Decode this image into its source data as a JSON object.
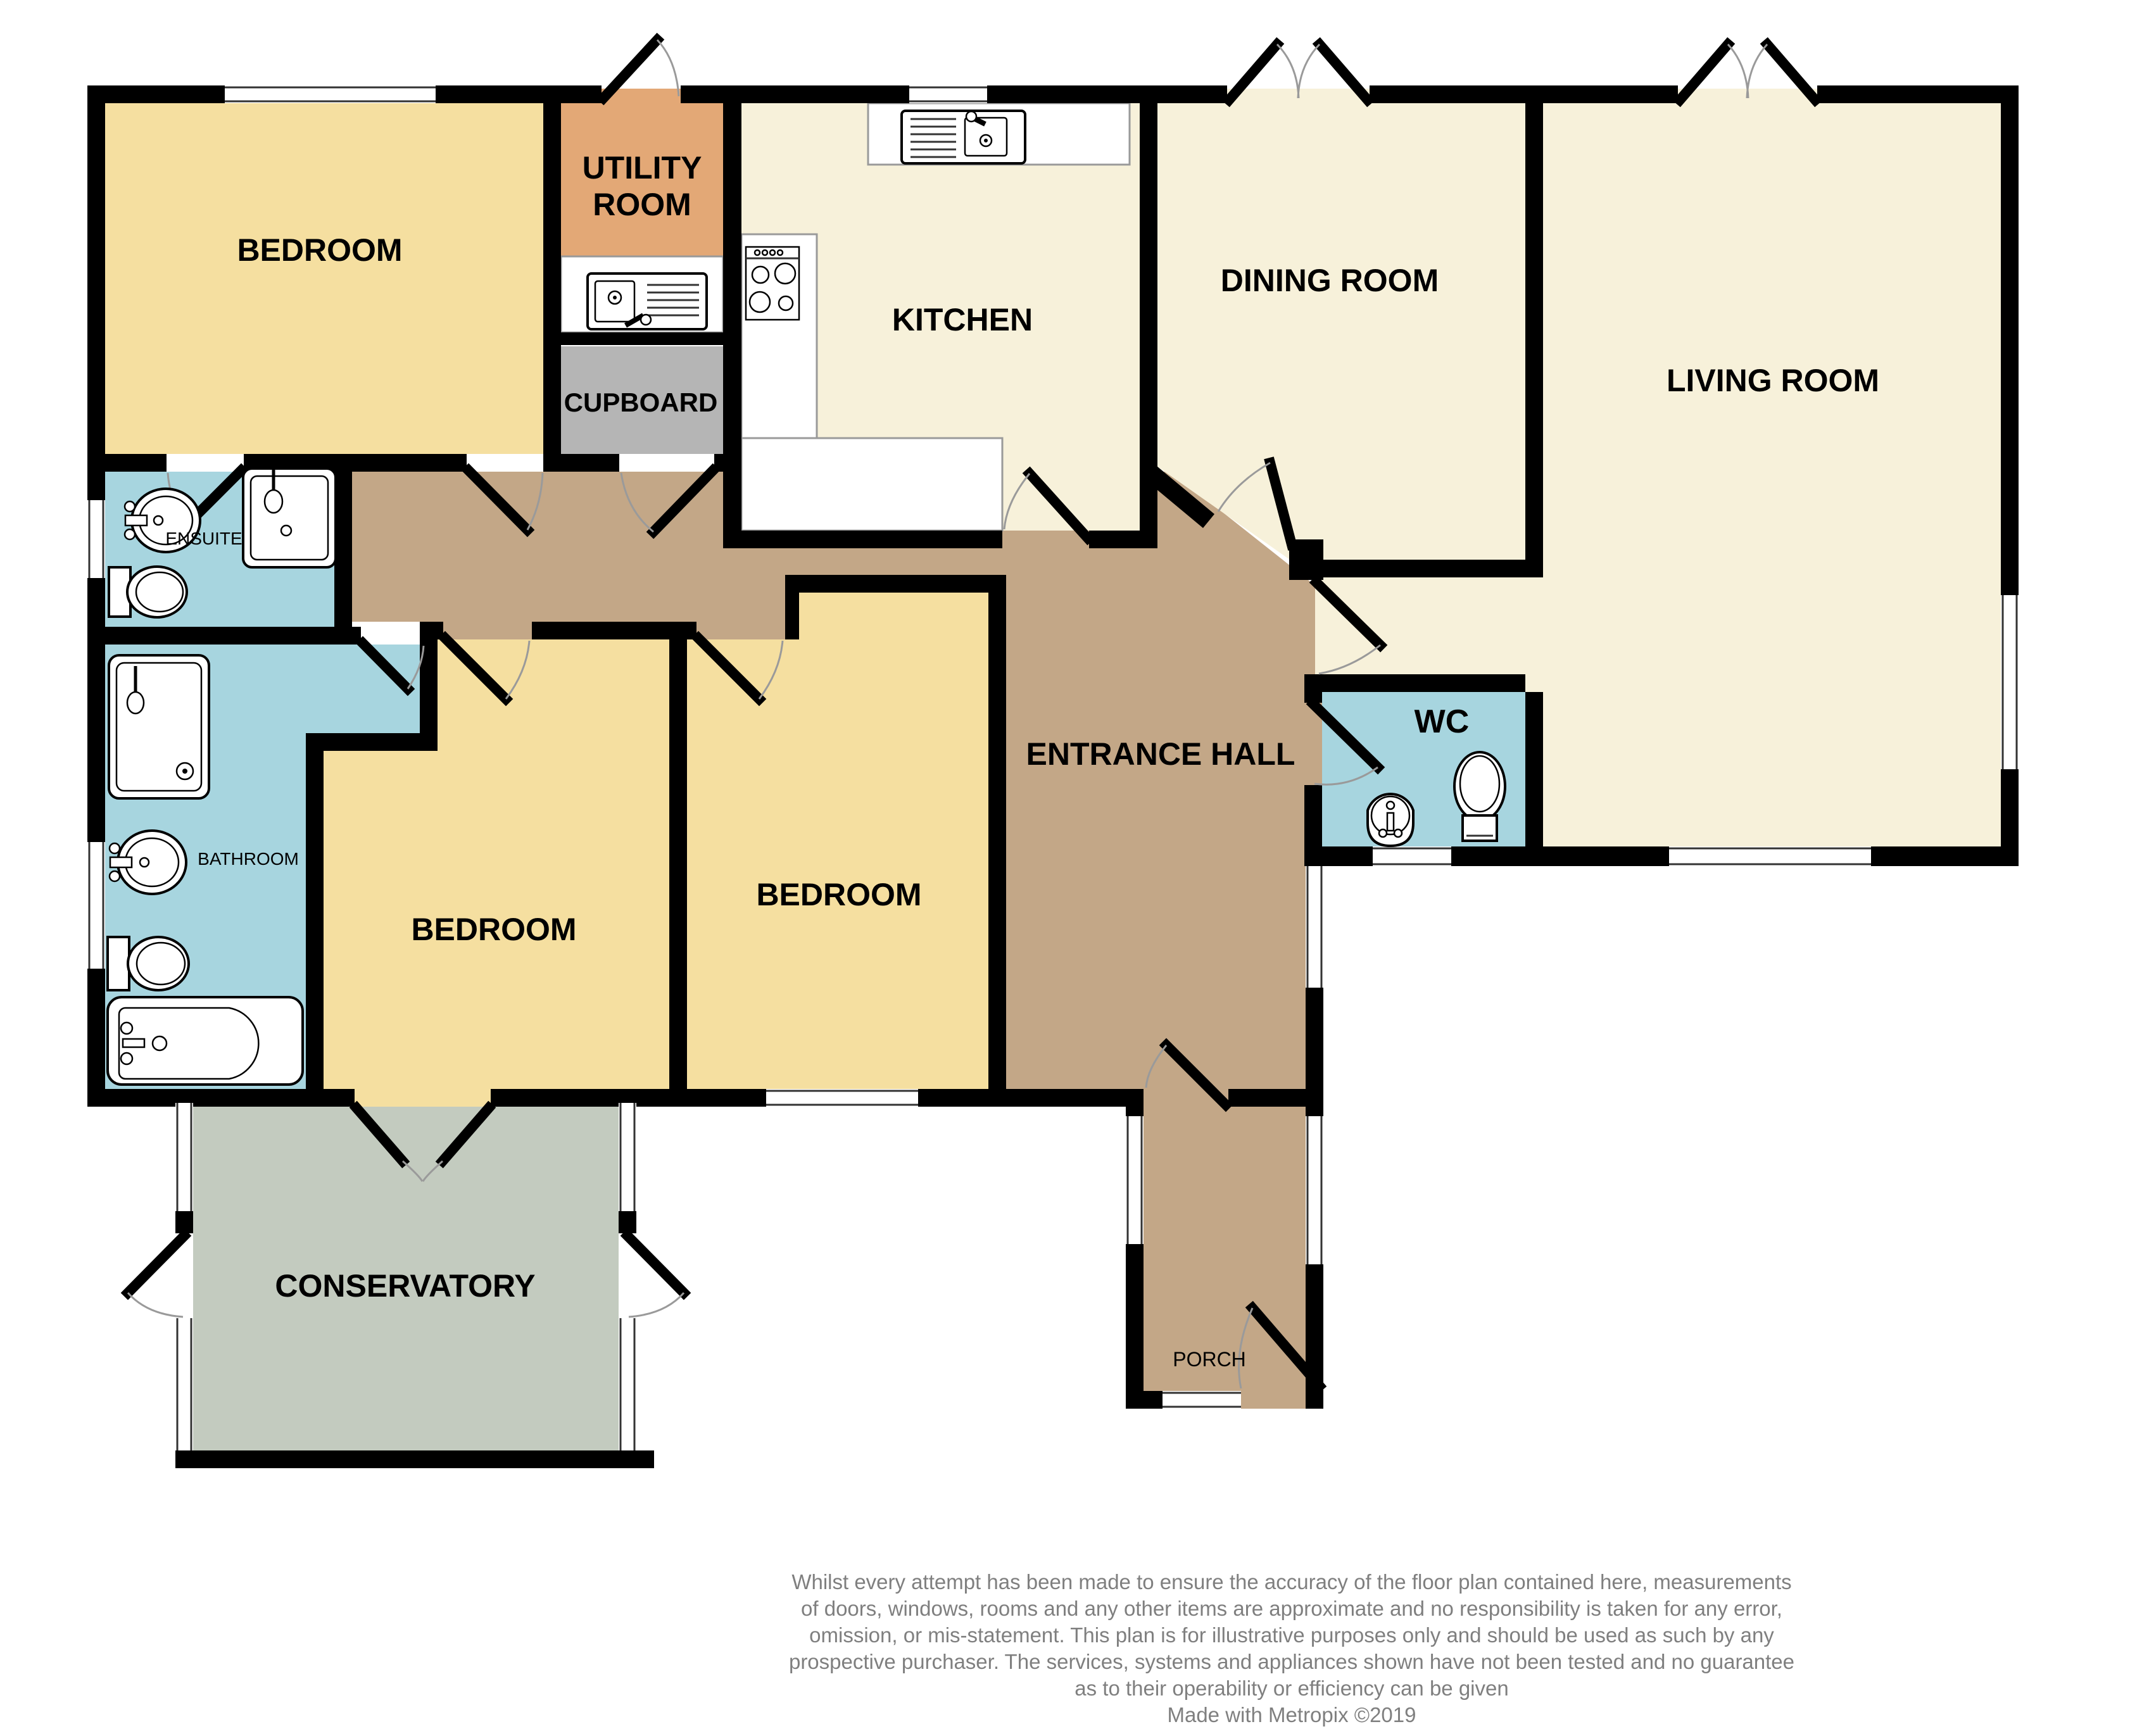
{
  "plan": {
    "title": "Bungalow floor plan",
    "rooms": {
      "bedroom1": {
        "label": "BEDROOM"
      },
      "utility": {
        "label": "UTILITY ROOM",
        "line1": "UTILITY",
        "line2": "ROOM"
      },
      "cupboard": {
        "label": "CUPBOARD"
      },
      "kitchen": {
        "label": "KITCHEN"
      },
      "dining": {
        "label": "DINING ROOM"
      },
      "living": {
        "label": "LIVING ROOM"
      },
      "ensuite": {
        "label": "ENSUITE"
      },
      "bathroom": {
        "label": "BATHROOM"
      },
      "bedroom3": {
        "label": "BEDROOM"
      },
      "bedroom2": {
        "label": "BEDROOM"
      },
      "hall": {
        "label": "ENTRANCE HALL"
      },
      "wc": {
        "label": "WC"
      },
      "conservatory": {
        "label": "CONSERVATORY"
      },
      "porch": {
        "label": "PORCH"
      }
    },
    "colors": {
      "wall": "#000000",
      "bedroom": "#F5DFA0",
      "cream": "#F7F1DA",
      "utility": "#E3A876",
      "cupboard": "#B5B5B5",
      "wet": "#A7D5DF",
      "hall": "#C3A787",
      "conservatory": "#C3CBBF",
      "counter": "#FFFFFF",
      "arc": "#9A9A9A",
      "disclaimer": "#7F7F7F"
    },
    "disclaimer": {
      "lines": [
        "Whilst every attempt has been made to ensure the accuracy of the floor plan contained here, measurements",
        "of doors, windows, rooms and any other items are approximate and no responsibility is taken for any error,",
        "omission, or mis-statement. This plan is for illustrative purposes only and should be used as such by any",
        "prospective purchaser. The services, systems and appliances shown have not been tested and no guarantee",
        "as to their operability or efficiency can be given",
        "Made with Metropix ©2019"
      ]
    }
  }
}
